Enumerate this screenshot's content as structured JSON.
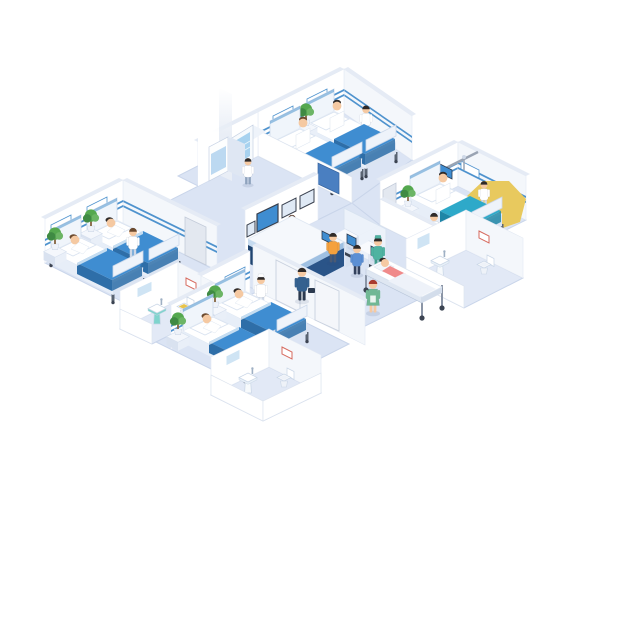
{
  "scene": {
    "title": "Isometric hospital floor illustration with patient wards, bathrooms, reception desk, self-service kiosks and medical staff",
    "background": "#ffffff"
  },
  "colors": {
    "floor": "#dbe4f4",
    "floorBath": "#e2e9f6",
    "floorEdge": "#c9d5ea",
    "wall": "#ffffff",
    "wallShade": "#f4f7fb",
    "wallCap": "#e5ebf5",
    "stripe": "#4f93ce",
    "blanket": "#3f8dd1",
    "blanketSide": "#2e6ea8",
    "blanketTeal": "#2ea9c9",
    "blanketTealSide": "#1f86a6",
    "plantGreen": "#55a84f",
    "plantDark": "#3f8a43",
    "deskNavy": "#1f4470",
    "deskNavySide": "#2a5488",
    "deskBand": "#c6dbf0",
    "deskTop": "#f5f8fc",
    "screenBlue": "#3f8dd1",
    "screenFrame": "#39404e",
    "glassWall": "#eef4fb",
    "doorGrey": "#e3e8f0",
    "doorBlue": "#4a7fc1",
    "yellowObject": "#e8c95e",
    "skin": "#f5c9a2",
    "hairDark": "#2f2a28",
    "hairBrown": "#6b4a2f",
    "hairRed": "#a93b2e",
    "coatWhite": "#ffffff",
    "scrubsTeal": "#4fb3a1",
    "dressGreen": "#71b895",
    "blueUniform": "#35618f",
    "orangeShirt": "#f5a13d",
    "patientPink": "#f08a8a",
    "toiletSeatYellow": "#e8c34a",
    "sinkTeal": "#7fd4cd",
    "gurneyFrame": "#8b95a6"
  },
  "rooms": [
    {
      "id": "ward-top",
      "name": "Patient ward, two beds",
      "beds": 2,
      "patients": "2 sitting",
      "staff": "1 nurse",
      "features": [
        "blue wall stripe",
        "headboard plaques",
        "potted plant",
        "blue door"
      ]
    },
    {
      "id": "ward-right",
      "name": "Patient room, one bed",
      "beds": 1,
      "patients": "1 in bed",
      "staff": "1 doctor, 1 nurse",
      "features": [
        "overhead monitor boom",
        "potted plant",
        "grey door",
        "teal blanket"
      ]
    },
    {
      "id": "ward-left",
      "name": "Patient ward, two beds",
      "beds": 2,
      "patients": "2 lying",
      "staff": "1 nurse",
      "features": [
        "blue wall stripe",
        "headboard plaques",
        "2 potted plants",
        "grey door"
      ]
    },
    {
      "id": "ward-bottom",
      "name": "Patient ward, two beds",
      "beds": 2,
      "patients": "2 lying",
      "staff": "1 nurse",
      "features": [
        "blue wall stripe",
        "headboard plaques",
        "2 potted plants"
      ]
    },
    {
      "id": "bathroom-right",
      "name": "Bathroom",
      "features": [
        "pedestal sink",
        "mirror",
        "toilet",
        "red wall picture"
      ]
    },
    {
      "id": "bathroom-left",
      "name": "Bathroom",
      "features": [
        "teal pedestal sink",
        "mirror",
        "yellow-seat toilet",
        "red wall picture"
      ]
    },
    {
      "id": "bathroom-bottom",
      "name": "Bathroom",
      "features": [
        "pedestal sink",
        "mirror",
        "toilet",
        "red wall picture"
      ]
    },
    {
      "id": "reception-area",
      "name": "Reception hall",
      "features": [
        "reception desk with illegible sign",
        "wall-mounted displays",
        "two self-service kiosks",
        "glass partition",
        "vending cooler and refrigerator",
        "patient gurney"
      ]
    }
  ],
  "people": [
    {
      "role": "receptionist",
      "outfit": "white coat",
      "location": "behind reception desk"
    },
    {
      "role": "kiosk user",
      "outfit": "orange shirt",
      "location": "left kiosk"
    },
    {
      "role": "kiosk user",
      "outfit": "blue shirt",
      "location": "right kiosk"
    },
    {
      "role": "staff member with bag",
      "outfit": "blue uniform",
      "location": "hallway"
    },
    {
      "role": "nurse",
      "outfit": "green dress",
      "location": "hallway"
    },
    {
      "role": "surgeon pushing gurney",
      "outfit": "teal scrubs and cap",
      "location": "hallway"
    },
    {
      "role": "patient on gurney",
      "outfit": "pink top",
      "location": "hallway"
    },
    {
      "role": "nurse",
      "outfit": "white coat",
      "location": "top ward"
    },
    {
      "role": "doctor",
      "outfit": "white coat",
      "location": "right room"
    },
    {
      "role": "nurse",
      "outfit": "white coat",
      "location": "right room"
    },
    {
      "role": "nurse",
      "outfit": "white coat",
      "location": "left ward"
    },
    {
      "role": "nurse",
      "outfit": "white coat and cap",
      "location": "bottom ward"
    },
    {
      "role": "visitor",
      "outfit": "white",
      "location": "vending machines"
    }
  ]
}
